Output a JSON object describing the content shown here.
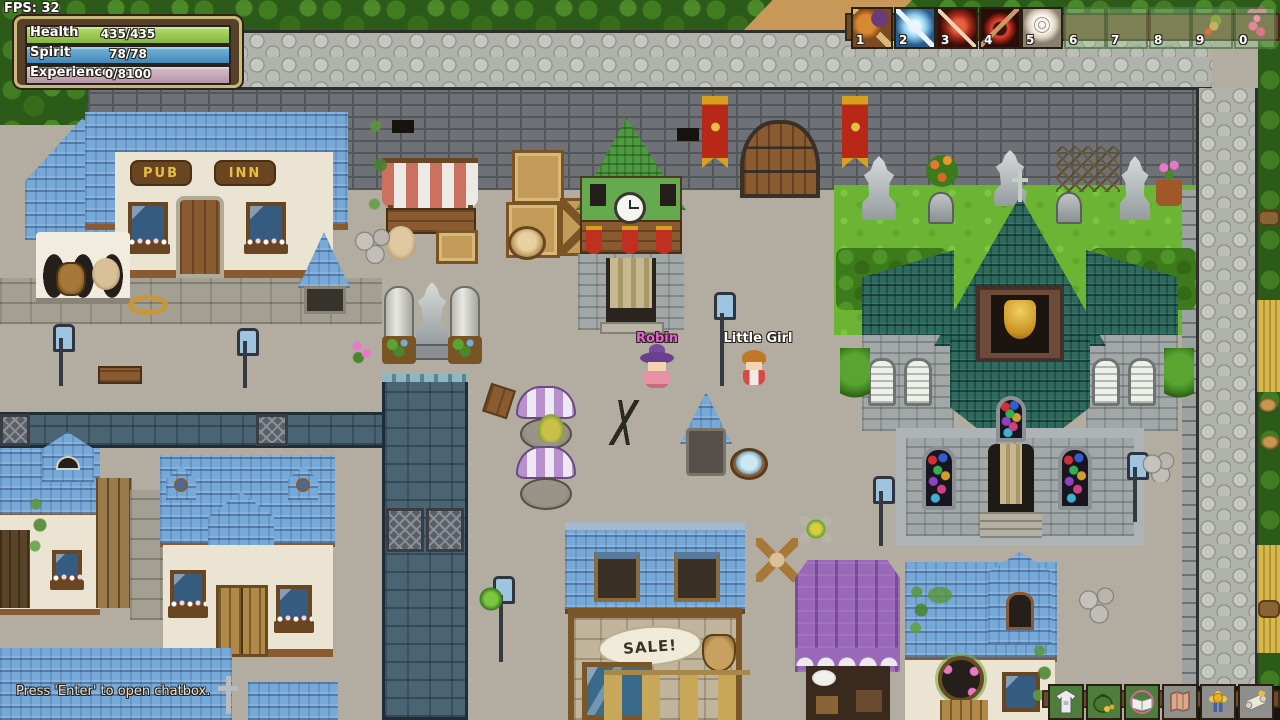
{
  "colors": {
    "health_bar": "#96c653",
    "spirit_bar": "#56a0d2",
    "experience_bar": "#c7aab9",
    "panel_border": "#c9b87e",
    "panel_bg": "#57402a",
    "hud_strip": "#6b4a2e",
    "name_robin": "#e862d8",
    "name_little_girl": "#ffffff"
  },
  "hud": {
    "fps": "FPS: 32",
    "status_panel": {
      "bars": [
        {
          "label": "Health",
          "value": "435/435"
        },
        {
          "label": "Spirit",
          "value": "78/78"
        },
        {
          "label": "Experience",
          "value": "0/8100"
        }
      ]
    },
    "hotbar": {
      "slots": [
        {
          "key": "1",
          "item": "club-skill",
          "filled": true
        },
        {
          "key": "2",
          "item": "frost-blade-skill",
          "filled": true
        },
        {
          "key": "3",
          "item": "crimson-blade-skill",
          "filled": true
        },
        {
          "key": "4",
          "item": "blood-axe-skill",
          "filled": true
        },
        {
          "key": "5",
          "item": "swirl-consumable",
          "filled": true
        },
        {
          "key": "6",
          "item": "",
          "filled": false
        },
        {
          "key": "7",
          "item": "",
          "filled": false
        },
        {
          "key": "8",
          "item": "",
          "filled": false
        },
        {
          "key": "9",
          "item": "",
          "filled": false
        },
        {
          "key": "0",
          "item": "",
          "filled": false
        }
      ]
    },
    "chat_hint": "Press 'Enter' to open chatbox.",
    "menu": {
      "buttons": [
        {
          "name": "equipment"
        },
        {
          "name": "inventory"
        },
        {
          "name": "spellbook"
        },
        {
          "name": "map"
        },
        {
          "name": "achievements"
        },
        {
          "name": "quests"
        }
      ]
    }
  },
  "world": {
    "characters": [
      {
        "name": "Robin"
      },
      {
        "name": "Little Girl"
      }
    ],
    "signs": {
      "pub": "PUB",
      "inn": "INN",
      "sale": "SALE!"
    }
  }
}
